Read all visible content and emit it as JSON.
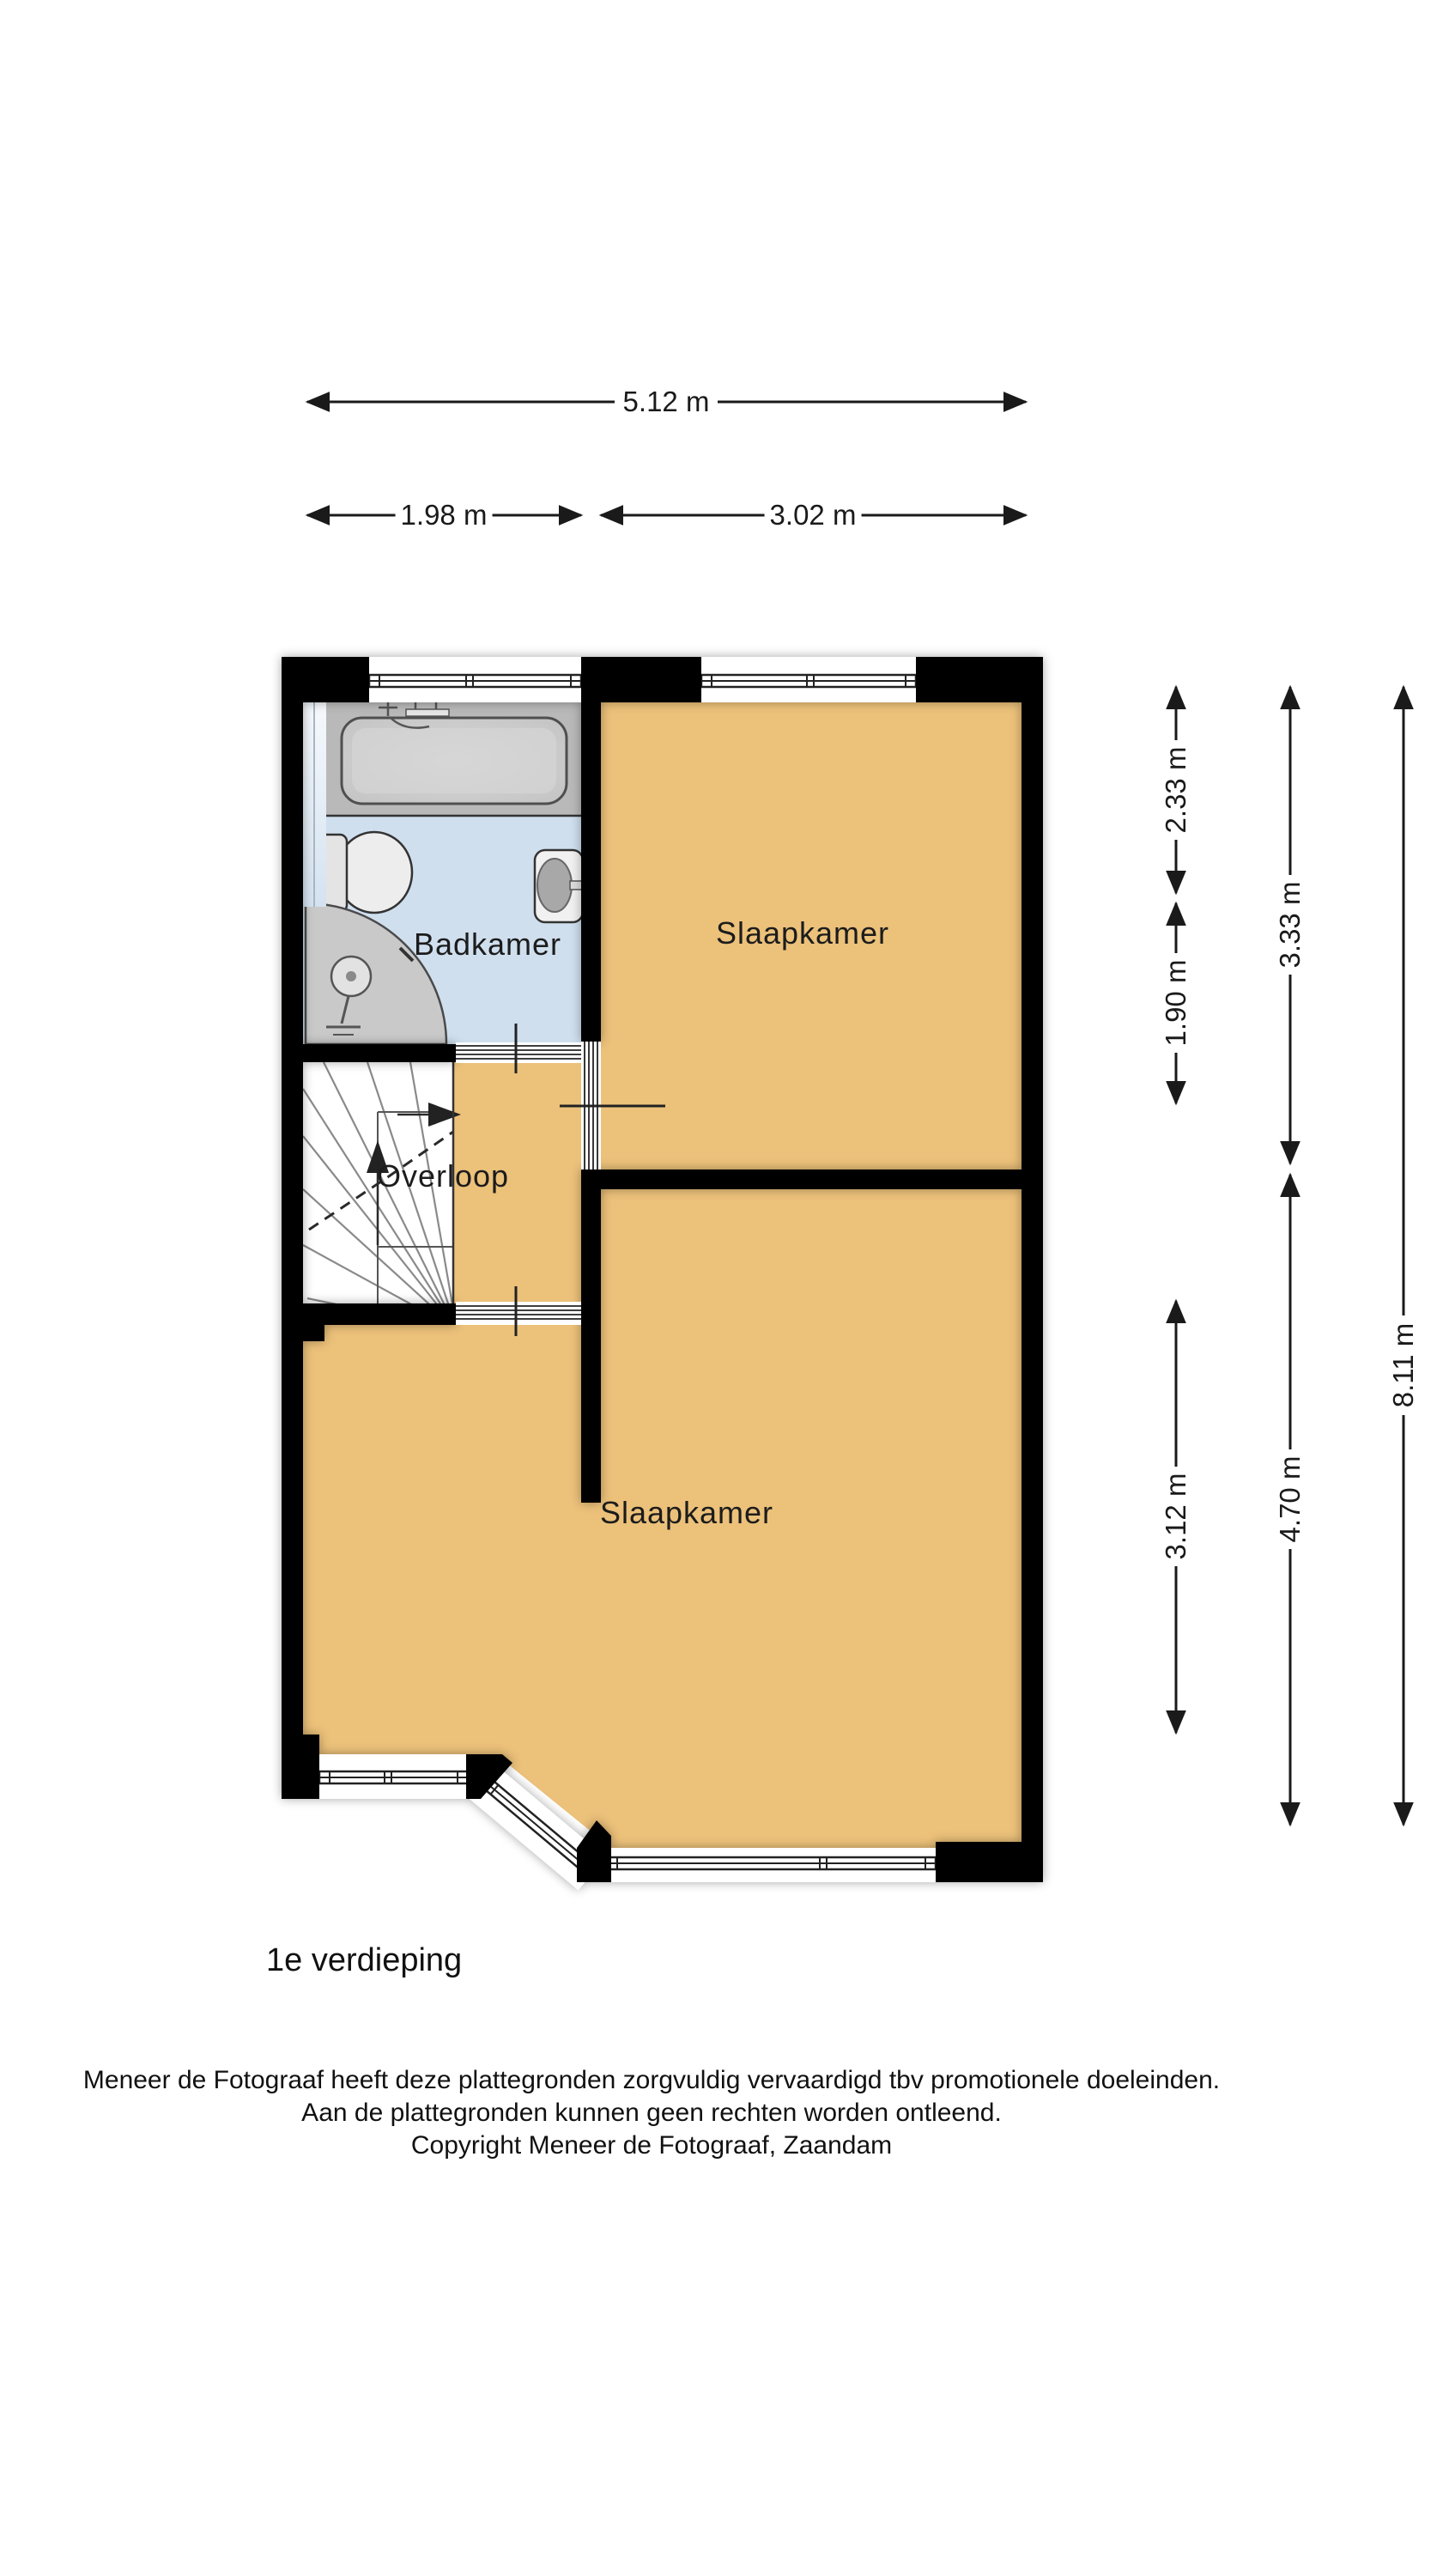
{
  "page": {
    "title": "1e verdieping"
  },
  "rooms": {
    "bathroom": "Badkamer",
    "bedroom_top": "Slaapkamer",
    "landing": "Overloop",
    "bedroom_bottom": "Slaapkamer"
  },
  "dimensions": {
    "top_total": "5.12 m",
    "top_left": "1.98 m",
    "top_right": "3.02 m",
    "right_col1_top": "2.33 m",
    "right_col1_mid": "1.90 m",
    "right_col1_bottom": "3.12 m",
    "right_col2_top": "3.33 m",
    "right_col2_bottom": "4.70 m",
    "right_col3_total": "8.11 m"
  },
  "footer": {
    "line1": "Meneer de Fotograaf heeft deze plattegronden zorgvuldig vervaardigd tbv promotionele doeleinden.",
    "line2": "Aan de plattegronden kunnen geen rechten worden ontleend.",
    "line3": "Copyright Meneer de Fotograaf, Zaandam"
  },
  "colors": {
    "wall": "#000000",
    "floor": "#ecc17a",
    "bathroom_floor": "#cfdfee",
    "fixture_gray": "#b9b9b9",
    "dimension": "#1a1a1a",
    "page_bg": "#ffffff"
  }
}
